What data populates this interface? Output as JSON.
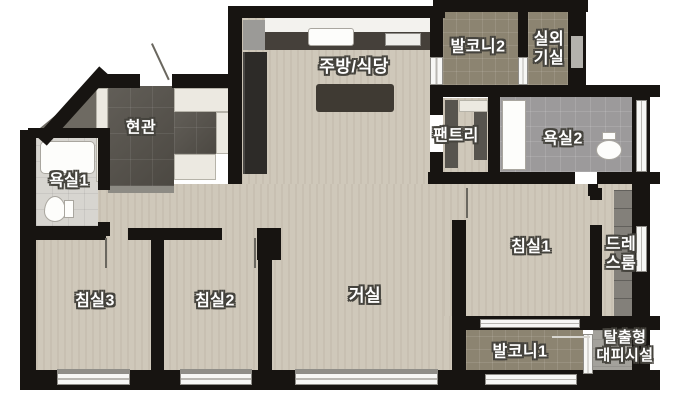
{
  "title": "apartment-floor-plan",
  "rooms": {
    "entrance": {
      "label": "현관"
    },
    "kitchen_dining": {
      "label": "주방/식당"
    },
    "balcony2": {
      "label": "발코니2"
    },
    "outdoor_unit_room": {
      "line1": "실외",
      "line2": "기실"
    },
    "pantry": {
      "label": "팬트리"
    },
    "bathroom2": {
      "label": "욕실2"
    },
    "bathroom1": {
      "label": "욕실1"
    },
    "bedroom1": {
      "label": "침실1"
    },
    "dressroom": {
      "line1": "드레",
      "line2": "스룸"
    },
    "bedroom3": {
      "label": "침실3"
    },
    "bedroom2": {
      "label": "침실2"
    },
    "living": {
      "label": "거실"
    },
    "balcony1": {
      "label": "발코니1"
    },
    "escape_shelter": {
      "line1": "탈출형",
      "line2": "대피시설"
    }
  },
  "colors": {
    "wall": "#171411",
    "wood": "#cfc8ba",
    "balcony": "#8c8471",
    "entrance": "#56524b",
    "bath1": "#d7d5d0",
    "bath2": "#9c9a9b",
    "escape": "#a3a19b",
    "counter_dark": "#45403a",
    "bg": "#ffffff"
  }
}
